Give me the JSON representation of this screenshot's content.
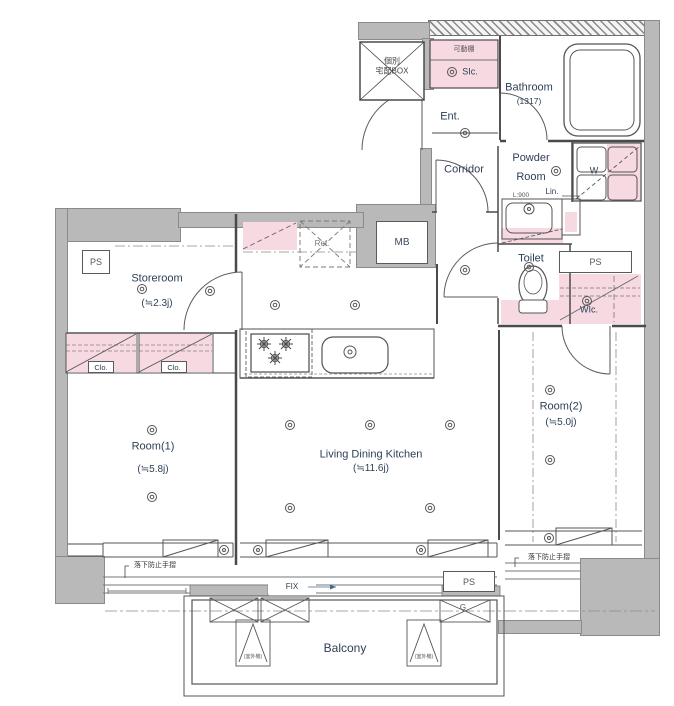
{
  "meta": {
    "type": "apartment-floor-plan"
  },
  "colors": {
    "wall_gray": "#b9b9b9",
    "closet_pink": "#f7d9e2",
    "line": "#4a4a4a",
    "label_navy": "#2e4057",
    "label_gray": "#555555"
  },
  "rooms": {
    "entrance": {
      "name": "Ent."
    },
    "corridor": {
      "name": "Corridor"
    },
    "bathroom": {
      "name": "Bathroom",
      "size": "(1317)"
    },
    "powder_room": {
      "line1": "Powder",
      "line2": "Room"
    },
    "toilet": {
      "name": "Toilet"
    },
    "storeroom": {
      "name": "Storeroom",
      "size": "(≒2.3j)"
    },
    "room1": {
      "name": "Room(1)",
      "size": "(≒5.8j)"
    },
    "room2": {
      "name": "Room(2)",
      "size": "(≒5.0j)"
    },
    "ldk": {
      "name": "Living Dining Kitchen",
      "size": "(≒11.6j)"
    },
    "balcony": {
      "name": "Balcony"
    }
  },
  "storage": {
    "shoes_in_closet": "SIc.",
    "walk_in_closet": "WIc.",
    "closet1": "Clo.",
    "closet2": "Clo.",
    "linen": "Lin.",
    "movable_shelf": "可動棚"
  },
  "equipment": {
    "delivery_box_line1": "個別",
    "delivery_box_line2": "宅配BOX",
    "meter_box": "MB",
    "refrigerator": "Ref.",
    "washer": "W",
    "gas_meter": "G",
    "pipe_space_left": "PS",
    "pipe_space_right": "PS",
    "pipe_space_bottom": "PS",
    "vanity_width": "L:900",
    "fixed_window": "FIX",
    "handrail_left": "落下防止手摺",
    "handrail_right": "落下防止手摺",
    "outdoor_unit_left": "(室外機)",
    "outdoor_unit_right": "(室外機)"
  }
}
